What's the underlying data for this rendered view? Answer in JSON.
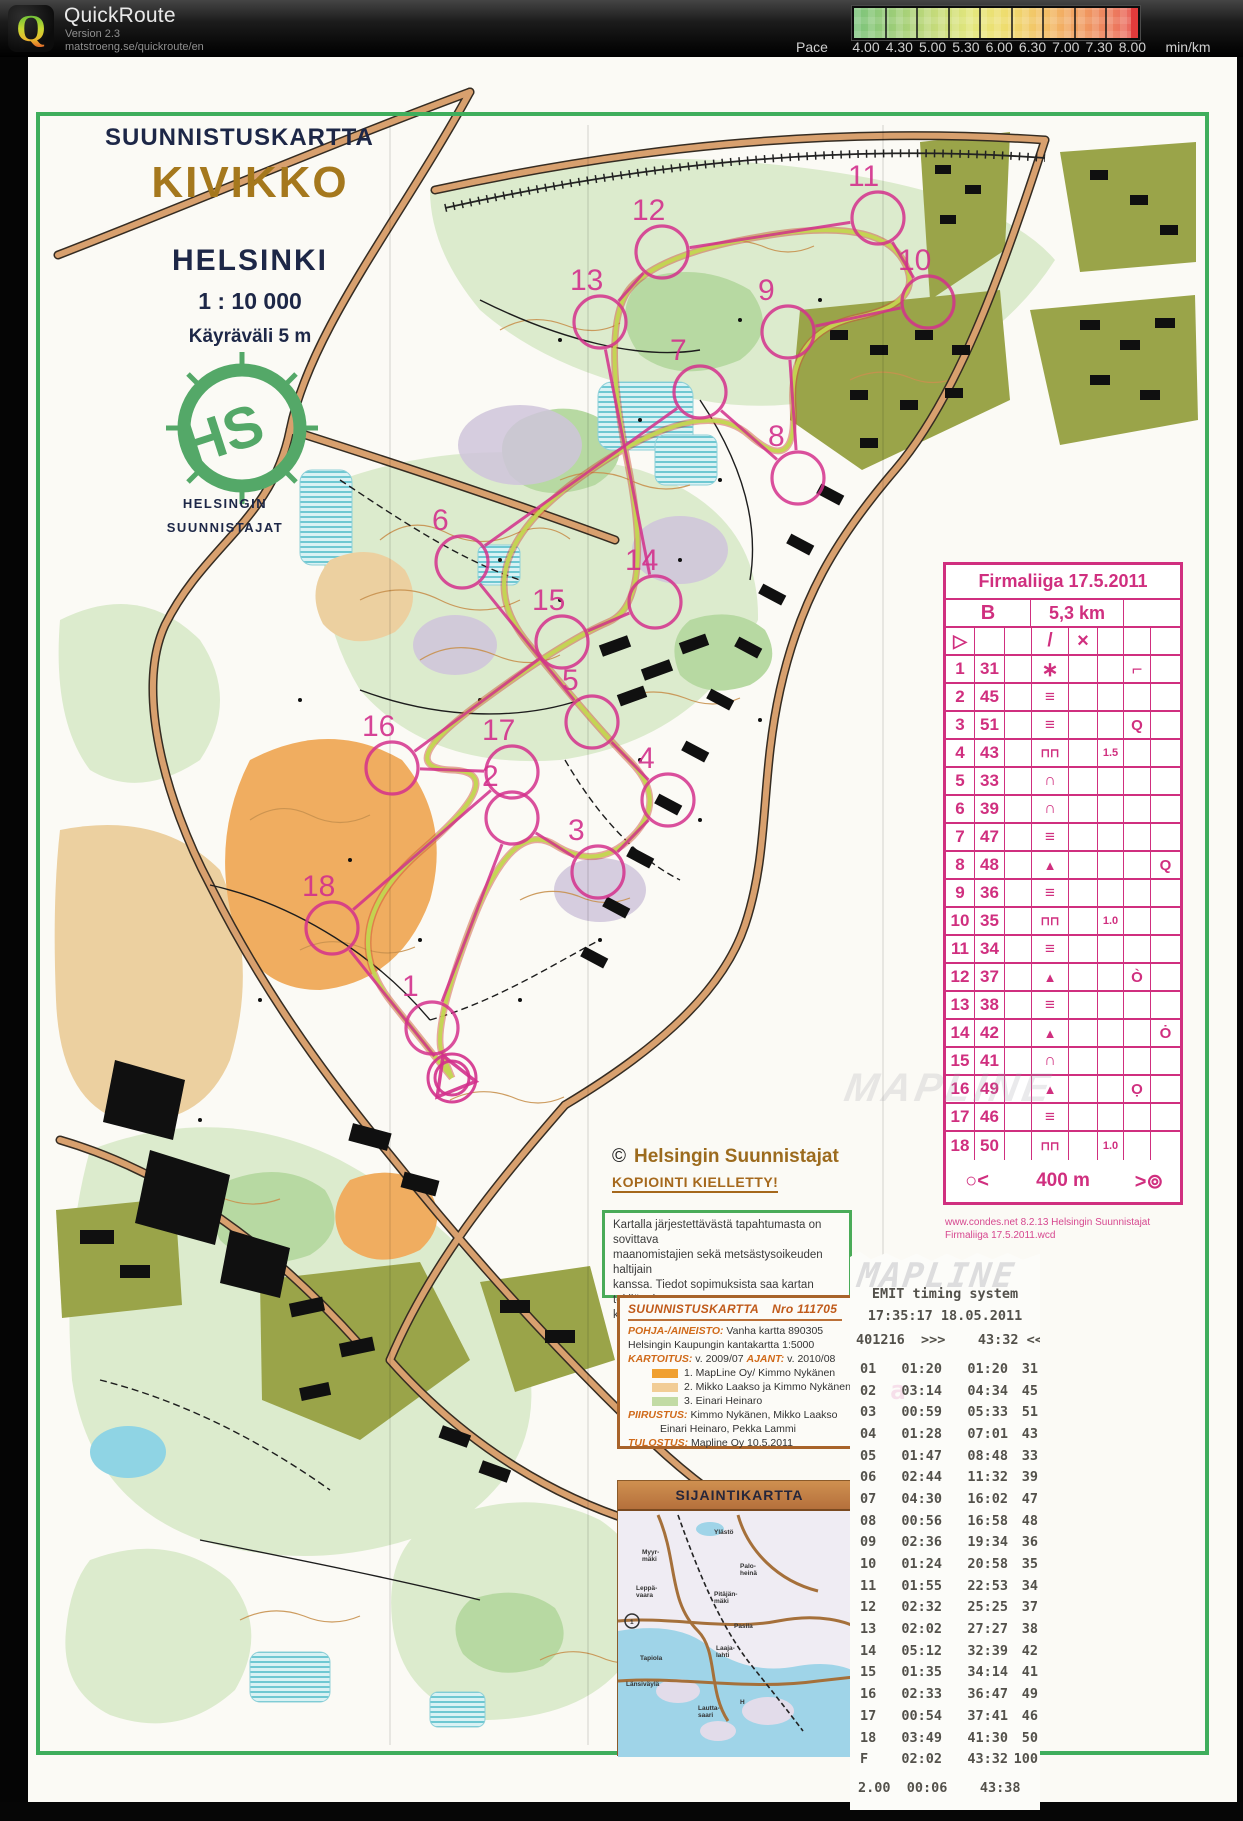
{
  "app": {
    "name": "QuickRoute",
    "version": "Version 2.3",
    "url": "matstroeng.se/quickroute/en"
  },
  "pace_scale": {
    "label": "Pace",
    "unit": "min/km",
    "ticks": [
      "4.00",
      "4.30",
      "5.00",
      "5.30",
      "6.00",
      "6.30",
      "7.00",
      "7.30",
      "8.00"
    ],
    "color_stops": [
      "#7cc47c",
      "#9ccd78",
      "#c3da7a",
      "#e5e77c",
      "#efdc6e",
      "#f3bd66",
      "#f09c60",
      "#ed7d5e",
      "#e85f5f"
    ]
  },
  "map": {
    "title_block": {
      "header": "SUUNNISTUSKARTTA",
      "title": "KIVIKKO",
      "city": "HELSINKI",
      "scale": "1 : 10 000",
      "contour_interval": "Käyräväli  5 m",
      "club_line1": "HELSINGIN",
      "club_line2": "SUUNNISTAJAT"
    },
    "copyright": {
      "symbol": "©",
      "owner": "Helsingin Suunnistajat",
      "notice": "KOPIOINTI  KIELLETTY!"
    },
    "permission_box": [
      "Kartalla järjestettävästä tapahtumasta on sovittava",
      "maanomistajien sekä metsästysoikeuden haltijain",
      "kanssa. Tiedot sopimuksista saa kartan tekijänoi-",
      "keuden Helsingin Suunnistajat ry:ltä."
    ],
    "credits_box": {
      "title_left": "SUUNNISTUSKARTTA",
      "title_right": "Nro  111705",
      "rows": [
        {
          "label": "POHJA-/AINEISTO:",
          "text": "Vanha kartta  890305"
        },
        {
          "label": "",
          "text": "Helsingin Kaupungin kantakartta 1:5000"
        },
        {
          "label": "KARTOITUS:",
          "text": "v. 2009/07",
          "label2": "AJANT:",
          "text2": "v. 2010/08"
        },
        {
          "swatch": "#f0a030",
          "text": "1.  MapLine Oy/ Kimmo Nykänen"
        },
        {
          "swatch": "#f2cd96",
          "text": "2.  Mikko Laakso ja Kimmo Nykänen"
        },
        {
          "swatch": "#c2dba4",
          "text": "3.  Einari Heinaro"
        },
        {
          "label": "PIIRUSTUS:",
          "text": "Kimmo Nykänen, Mikko Laakso"
        },
        {
          "label": "",
          "text": "Einari Heinaro, Pekka Lammi",
          "indent": true
        },
        {
          "label": "TULOSTUS:",
          "text": "Mapline Oy  10.5.2011"
        }
      ]
    },
    "inset": {
      "title": "SIJAINTIKARTTA",
      "labels": [
        {
          "text": "Ylästö",
          "x": 96,
          "y": 48
        },
        {
          "text": "Myyr-\nmäki",
          "x": 24,
          "y": 68
        },
        {
          "text": "Palo-\nheinä",
          "x": 122,
          "y": 82
        },
        {
          "text": "Leppä-\nvaara",
          "x": 18,
          "y": 104
        },
        {
          "text": "Pitäjän-\nmäki",
          "x": 96,
          "y": 110
        },
        {
          "text": "Pasila",
          "x": 116,
          "y": 142
        },
        {
          "text": "1",
          "x": 12,
          "y": 138
        },
        {
          "text": "Tapiola",
          "x": 22,
          "y": 174
        },
        {
          "text": "Laaja-\nlahti",
          "x": 98,
          "y": 164
        },
        {
          "text": "Länsiväylä",
          "x": 8,
          "y": 200
        },
        {
          "text": "Lautta-\nsaari",
          "x": 80,
          "y": 224
        },
        {
          "text": "H",
          "x": 122,
          "y": 218
        }
      ]
    }
  },
  "control_card": {
    "title": "Firmaliiga 17.5.2011",
    "course": "B",
    "length": "5,3 km",
    "start_row": {
      "a": "start",
      "d": "slash",
      "e": "cross"
    },
    "rows": [
      {
        "n": "1",
        "code": "31",
        "d": "stony-ground",
        "f": "",
        "g": "flag",
        "h": ""
      },
      {
        "n": "2",
        "code": "45",
        "d": "marsh",
        "f": "",
        "g": "",
        "h": ""
      },
      {
        "n": "3",
        "code": "51",
        "d": "marsh",
        "f": "",
        "g": "circle-tail",
        "h": ""
      },
      {
        "n": "4",
        "code": "43",
        "d": "wall",
        "f": "1.5",
        "g": "",
        "h": ""
      },
      {
        "n": "5",
        "code": "33",
        "d": "knoll",
        "f": "",
        "g": "",
        "h": ""
      },
      {
        "n": "6",
        "code": "39",
        "d": "knoll",
        "f": "",
        "g": "",
        "h": ""
      },
      {
        "n": "7",
        "code": "47",
        "d": "marsh",
        "f": "",
        "g": "",
        "h": ""
      },
      {
        "n": "8",
        "code": "48",
        "d": "boulder",
        "f": "",
        "g": "",
        "h": "circle-dot"
      },
      {
        "n": "9",
        "code": "36",
        "d": "marsh",
        "f": "",
        "g": "",
        "h": ""
      },
      {
        "n": "10",
        "code": "35",
        "d": "wall",
        "f": "1.0",
        "g": "",
        "h": ""
      },
      {
        "n": "11",
        "code": "34",
        "d": "marsh",
        "f": "",
        "g": "",
        "h": ""
      },
      {
        "n": "12",
        "code": "37",
        "d": "boulder",
        "f": "",
        "g": "circle-tick",
        "h": ""
      },
      {
        "n": "13",
        "code": "38",
        "d": "marsh",
        "f": "",
        "g": "",
        "h": ""
      },
      {
        "n": "14",
        "code": "42",
        "d": "boulder",
        "f": "",
        "g": "",
        "h": "circle-dot-top"
      },
      {
        "n": "15",
        "code": "41",
        "d": "knoll",
        "f": "",
        "g": "",
        "h": ""
      },
      {
        "n": "16",
        "code": "49",
        "d": "boulder",
        "f": "",
        "g": "circle-dot-bottom",
        "h": ""
      },
      {
        "n": "17",
        "code": "46",
        "d": "marsh",
        "f": "",
        "g": "",
        "h": ""
      },
      {
        "n": "18",
        "code": "50",
        "d": "wall",
        "f": "1.0",
        "g": "",
        "h": ""
      }
    ],
    "footer": {
      "start_sym": "○<",
      "distance": "400 m",
      "finish_sym": ">⊚"
    },
    "credit1": "www.condes.net 8.2.13 Helsingin Suunnistajat",
    "credit2": "Firmaliiga 17.5.2011.wcd"
  },
  "course": {
    "color": "#d3308c",
    "points": [
      {
        "n": "S",
        "x": 452,
        "y": 1078
      },
      {
        "n": "1",
        "x": 432,
        "y": 1028
      },
      {
        "n": "2",
        "x": 512,
        "y": 818
      },
      {
        "n": "3",
        "x": 598,
        "y": 872
      },
      {
        "n": "4",
        "x": 668,
        "y": 800
      },
      {
        "n": "5",
        "x": 592,
        "y": 722
      },
      {
        "n": "6",
        "x": 462,
        "y": 562
      },
      {
        "n": "7",
        "x": 700,
        "y": 392
      },
      {
        "n": "8",
        "x": 798,
        "y": 478
      },
      {
        "n": "9",
        "x": 788,
        "y": 332
      },
      {
        "n": "10",
        "x": 928,
        "y": 302
      },
      {
        "n": "11",
        "x": 878,
        "y": 218
      },
      {
        "n": "12",
        "x": 662,
        "y": 252
      },
      {
        "n": "13",
        "x": 600,
        "y": 322
      },
      {
        "n": "14",
        "x": 655,
        "y": 602
      },
      {
        "n": "15",
        "x": 562,
        "y": 642
      },
      {
        "n": "16",
        "x": 392,
        "y": 768
      },
      {
        "n": "17",
        "x": 512,
        "y": 772
      },
      {
        "n": "18",
        "x": 332,
        "y": 928
      },
      {
        "n": "F",
        "x": 452,
        "y": 1078
      }
    ]
  },
  "receipt": {
    "title": "EMIT timing system",
    "datetime": "17:35:17  18.05.2011",
    "card_line": "401216  >>>    43:32 <<<",
    "rows": [
      [
        "01",
        "01:20",
        "01:20",
        "31"
      ],
      [
        "02",
        "03:14",
        "04:34",
        "45"
      ],
      [
        "03",
        "00:59",
        "05:33",
        "51"
      ],
      [
        "04",
        "01:28",
        "07:01",
        "43"
      ],
      [
        "05",
        "01:47",
        "08:48",
        "33"
      ],
      [
        "06",
        "02:44",
        "11:32",
        "39"
      ],
      [
        "07",
        "04:30",
        "16:02",
        "47"
      ],
      [
        "08",
        "00:56",
        "16:58",
        "48"
      ],
      [
        "09",
        "02:36",
        "19:34",
        "36"
      ],
      [
        "10",
        "01:24",
        "20:58",
        "35"
      ],
      [
        "11",
        "01:55",
        "22:53",
        "34"
      ],
      [
        "12",
        "02:32",
        "25:25",
        "37"
      ],
      [
        "13",
        "02:02",
        "27:27",
        "38"
      ],
      [
        "14",
        "05:12",
        "32:39",
        "42"
      ],
      [
        "15",
        "01:35",
        "34:14",
        "41"
      ],
      [
        "16",
        "02:33",
        "36:47",
        "49"
      ],
      [
        "17",
        "00:54",
        "37:41",
        "46"
      ],
      [
        "F",
        "02:02",
        "43:32",
        "100"
      ]
    ],
    "row18": [
      "18",
      "03:49",
      "41:30",
      "50"
    ],
    "total_line": "2.00  00:06    43:38",
    "watermark": "MAPLINE"
  }
}
